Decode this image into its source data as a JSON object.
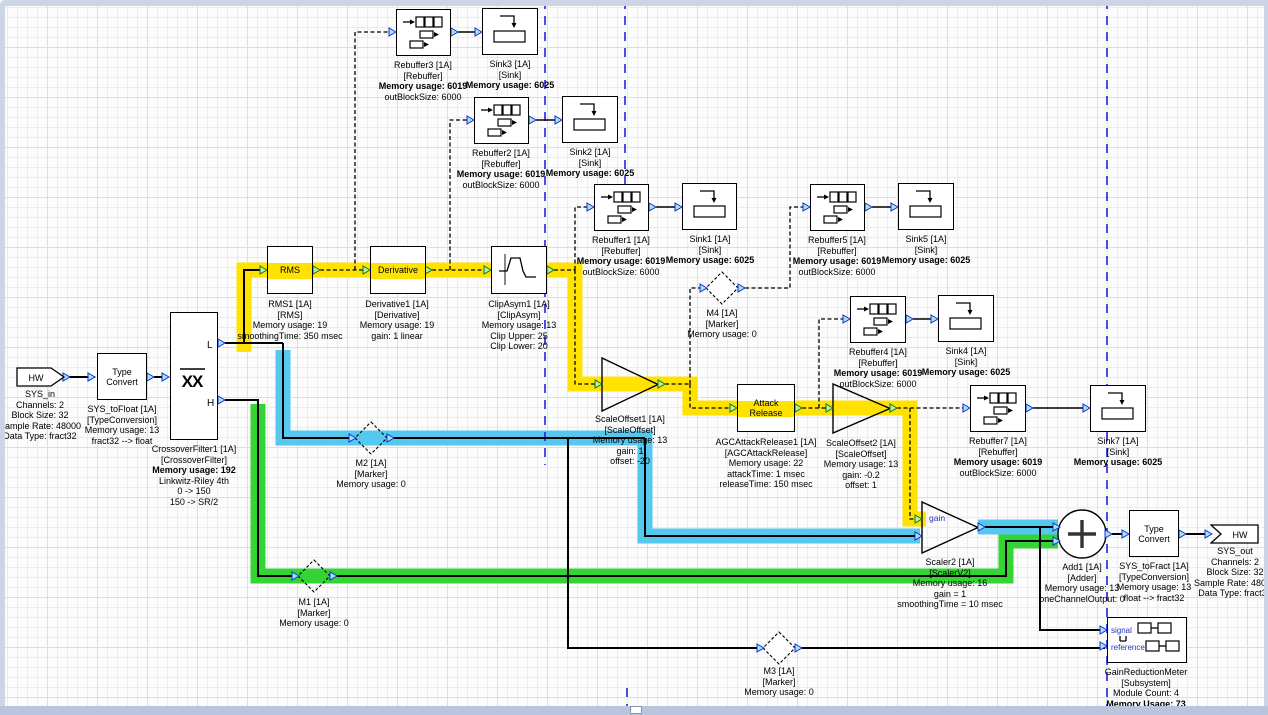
{
  "colors": {
    "yellow": "#ffe200",
    "cyan": "#55c8f0",
    "green": "#35d435",
    "guide": "#2222dd",
    "port_blue_fill": "#a8e0f8",
    "port_blue_stroke": "#1133cc",
    "port_green_fill": "#b8f0a8",
    "port_green_stroke": "#117711",
    "blue_text": "#2233bb"
  },
  "blocks": {
    "sys_in": {
      "shape_text": "HW",
      "label": [
        "SYS_in",
        "Channels: 2",
        "Block Size: 32",
        "Sample Rate: 48000",
        "Data Type: fract32"
      ]
    },
    "typeconv_in": {
      "box_text": "Type Convert",
      "label": [
        "SYS_toFloat [1A]",
        "[TypeConversion]",
        "Memory usage: 13",
        "fract32 --> float"
      ]
    },
    "crossover": {
      "icon_text": "XX",
      "port_low": "L",
      "port_high": "H",
      "label": [
        "CrossoverFilter1 [1A]",
        "[CrossoverFilter]",
        "Memory usage: 192",
        "Linkwitz-Riley 4th",
        "0 -> 150",
        "150 -> SR/2"
      ]
    },
    "rms": {
      "box_text": "RMS",
      "label": [
        "RMS1 [1A]",
        "[RMS]",
        "Memory usage: 19",
        "smoothingTime: 350 msec"
      ]
    },
    "derivative": {
      "box_text": "Derivative",
      "label": [
        "Derivative1 [1A]",
        "[Derivative]",
        "Memory usage: 19",
        "gain: 1 linear"
      ]
    },
    "clipasym": {
      "label": [
        "ClipAsym1 [1A]",
        "[ClipAsym]",
        "Memory usage: 13",
        "Clip Upper: 25",
        "Clip Lower: 20"
      ]
    },
    "rebuffer1": {
      "label": [
        "Rebuffer1 [1A]",
        "[Rebuffer]",
        "Memory usage: 6019",
        "outBlockSize: 6000"
      ]
    },
    "rebuffer2": {
      "label": [
        "Rebuffer2 [1A]",
        "[Rebuffer]",
        "Memory usage: 6019",
        "outBlockSize: 6000"
      ]
    },
    "rebuffer3": {
      "label": [
        "Rebuffer3 [1A]",
        "[Rebuffer]",
        "Memory usage: 6019",
        "outBlockSize: 6000"
      ]
    },
    "rebuffer4": {
      "label": [
        "Rebuffer4 [1A]",
        "[Rebuffer]",
        "Memory usage: 6019",
        "outBlockSize: 6000"
      ]
    },
    "rebuffer5": {
      "label": [
        "Rebuffer5 [1A]",
        "[Rebuffer]",
        "Memory usage: 6019",
        "outBlockSize: 6000"
      ]
    },
    "rebuffer7": {
      "label": [
        "Rebuffer7 [1A]",
        "[Rebuffer]",
        "Memory usage: 6019",
        "outBlockSize: 6000"
      ]
    },
    "sink1": {
      "label": [
        "Sink1 [1A]",
        "[Sink]",
        "Memory usage: 6025"
      ]
    },
    "sink2": {
      "label": [
        "Sink2 [1A]",
        "[Sink]",
        "Memory usage: 6025"
      ]
    },
    "sink3": {
      "label": [
        "Sink3 [1A]",
        "[Sink]",
        "Memory usage: 6025"
      ]
    },
    "sink4": {
      "label": [
        "Sink4 [1A]",
        "[Sink]",
        "Memory usage: 6025"
      ]
    },
    "sink5": {
      "label": [
        "Sink5 [1A]",
        "[Sink]",
        "Memory usage: 6025"
      ]
    },
    "sink7": {
      "label": [
        "Sink7 [1A]",
        "[Sink]",
        "Memory usage: 6025"
      ]
    },
    "m1": {
      "label": [
        "M1 [1A]",
        "[Marker]",
        "Memory usage: 0"
      ]
    },
    "m2": {
      "label": [
        "M2 [1A]",
        "[Marker]",
        "Memory usage: 0"
      ]
    },
    "m3": {
      "label": [
        "M3 [1A]",
        "[Marker]",
        "Memory usage: 0"
      ]
    },
    "m4": {
      "label": [
        "M4 [1A]",
        "[Marker]",
        "Memory usage: 0"
      ]
    },
    "scaleoffset1": {
      "label": [
        "ScaleOffset1 [1A]",
        "[ScaleOffset]",
        "Memory usage: 13",
        "gain: 1",
        "offset: -20"
      ]
    },
    "attackrelease": {
      "box_text": "Attack Release",
      "label": [
        "AGCAttackRelease1 [1A]",
        "[AGCAttackRelease]",
        "Memory usage: 22",
        "attackTime: 1 msec",
        "releaseTime: 150 msec"
      ]
    },
    "scaleoffset2": {
      "label": [
        "ScaleOffset2 [1A]",
        "[ScaleOffset]",
        "Memory usage: 13",
        "gain: -0.2",
        "offset: 1"
      ]
    },
    "scaler2": {
      "gain_label": "gain",
      "label": [
        "Scaler2 [1A]",
        "[ScalerV2]",
        "Memory usage: 16",
        "gain = 1",
        "smoothingTime = 10 msec"
      ]
    },
    "add1": {
      "label": [
        "Add1 [1A]",
        "[Adder]",
        "Memory usage: 13",
        "oneChannelOutput: 0"
      ]
    },
    "typeconv_out": {
      "box_text": "Type Convert",
      "label": [
        "SYS_toFract [1A]",
        "[TypeConversion]",
        "Memory usage: 13",
        "float --> fract32"
      ]
    },
    "sys_out": {
      "shape_text": "HW",
      "label": [
        "SYS_out",
        "Channels: 2",
        "Block Size: 32",
        "Sample Rate: 48000",
        "Data Type: fract32"
      ]
    },
    "grm": {
      "input_labels": [
        "signal",
        "reference"
      ],
      "label": [
        "GainReductionMeter",
        "[Subsystem]",
        "Module Count: 4",
        "Memory Usage: 73"
      ]
    }
  }
}
